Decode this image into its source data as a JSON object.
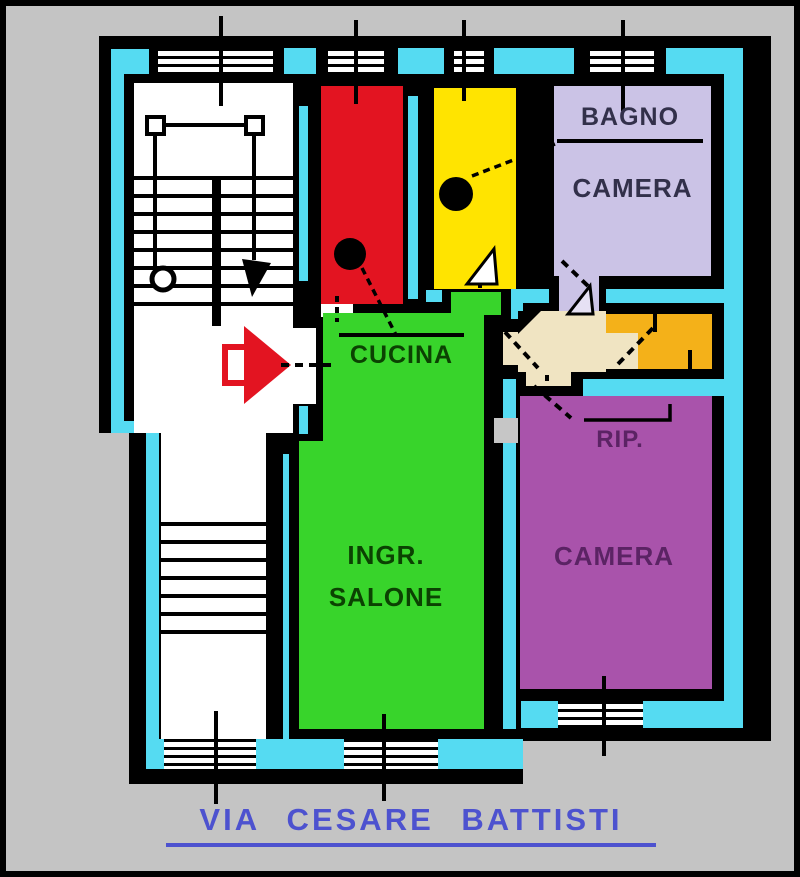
{
  "street": {
    "label": "VIA CESARE BATTISTI"
  },
  "rooms": {
    "kitchen": {
      "label": "CUCINA"
    },
    "bathroom": {
      "label": "BAGNO"
    },
    "bedroom_top": {
      "label": "CAMERA"
    },
    "bedroom_bottom": {
      "label": "CAMERA"
    },
    "storage": {
      "label": "RIP."
    },
    "living": {
      "line1": "INGR.",
      "line2": "SALONE"
    }
  },
  "icons": {
    "entry_arrow": "entry-direction-arrow",
    "stair_direction_arrow": "stair-direction-arrow"
  },
  "palette": {
    "page_bg": "#c4c4c4",
    "wall": "#000000",
    "common_cyan": "#55dbf2",
    "stair_white": "#ffffff",
    "kitchen_red": "#e31421",
    "bathroom_yellow": "#ffe400",
    "bedroom_lavender": "#cbc3e6",
    "living_green": "#38d42b",
    "storage_orange": "#f4b119",
    "bedroom_purple": "#a953ab",
    "hall_cream": "#f0e4c2",
    "shaft_gray": "#c6c6c6",
    "entry_arrow_red": "#e31421",
    "street_blue": "#4d52cf",
    "label_dark": "#32304a",
    "label_green": "#0b4202",
    "label_purple": "#5b2364"
  }
}
